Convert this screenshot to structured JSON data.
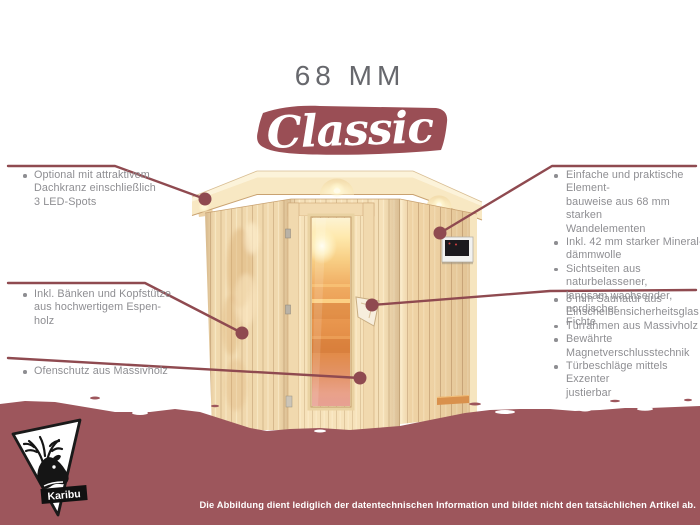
{
  "title": "68 MM",
  "banner": {
    "label": "Classic"
  },
  "colors": {
    "maroon_line": "#8f4a50",
    "maroon_band": "#9d565c",
    "banner_red": "#9a4e55",
    "text_gray": "#8e8e92",
    "title_gray": "#67686d",
    "wood_light": "#f5e0b8",
    "glass_orange": "#e8954f"
  },
  "icons": {
    "logo": "deer-head-icon",
    "bullet": "round-bullet"
  },
  "annotations": {
    "left": [
      {
        "lines": [
          "Optional mit attraktivem",
          "Dachkranz einschließlich",
          "3 LED-Spots"
        ]
      },
      {
        "lines": [
          "Inkl. Bänken und Kopfstütze",
          "aus hochwertigem Espen-",
          "holz"
        ]
      },
      {
        "lines": [
          "Ofenschutz aus Massivholz"
        ]
      }
    ],
    "right_top": [
      {
        "lines": [
          "Einfache und praktische Element-",
          "bauweise aus 68 mm starken",
          "Wandelementen"
        ]
      },
      {
        "lines": [
          "Inkl. 42 mm starker Mineral-",
          "dämmwolle"
        ]
      },
      {
        "lines": [
          "Sichtseiten aus naturbelassener,",
          "langsam wachsender, nordischer",
          "Fichte"
        ]
      }
    ],
    "right_bottom": [
      {
        "lines": [
          "8 mm Saunatür aus",
          "Einscheibensicherheitsglas"
        ]
      },
      {
        "lines": [
          "Türrahmen aus Massivholz"
        ]
      },
      {
        "lines": [
          "Bewährte Magnetverschlusstechnik"
        ]
      },
      {
        "lines": [
          "Türbeschläge mittels Exzenter",
          "justierbar"
        ]
      }
    ]
  },
  "logo": {
    "brand": "Karibu"
  },
  "footer": {
    "disclaimer": "Die Abbildung dient lediglich der datentechnischen Information und bildet nicht den tatsächlichen Artikel ab."
  }
}
